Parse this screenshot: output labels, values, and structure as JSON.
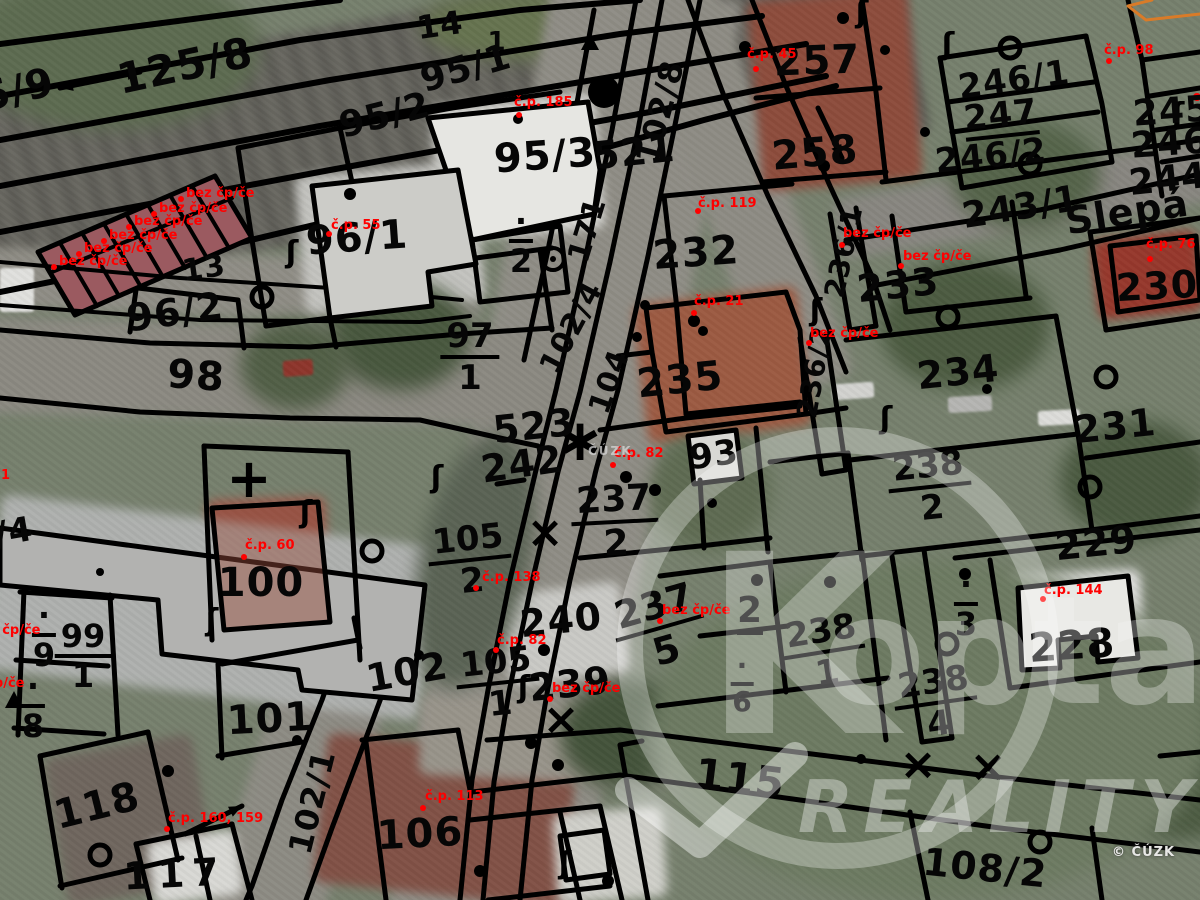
{
  "labels": {
    "parcels": [
      {
        "t": "5/9",
        "x": 18,
        "y": 90,
        "s": 40,
        "r": -14
      },
      {
        "t": "125/8",
        "x": 185,
        "y": 66,
        "s": 42,
        "r": -12
      },
      {
        "t": "14",
        "x": 440,
        "y": 25,
        "s": 32,
        "r": -8
      },
      {
        "t": "1",
        "x": 497,
        "y": 42,
        "s": 26,
        "r": 0
      },
      {
        "t": "95/1",
        "x": 466,
        "y": 69,
        "s": 36,
        "r": -16
      },
      {
        "t": "95/2",
        "x": 385,
        "y": 116,
        "s": 36,
        "r": -14
      },
      {
        "t": "95/3",
        "x": 545,
        "y": 156,
        "s": 40,
        "r": -4
      },
      {
        "t": "521",
        "x": 634,
        "y": 152,
        "s": 38,
        "r": -6
      },
      {
        "t": "102/8",
        "x": 660,
        "y": 112,
        "s": 32,
        "r": -75
      },
      {
        "t": "257",
        "x": 817,
        "y": 61,
        "s": 40,
        "r": -2
      },
      {
        "t": "258",
        "x": 815,
        "y": 153,
        "s": 40,
        "r": -5
      },
      {
        "t": "246/1",
        "x": 1014,
        "y": 80,
        "s": 34,
        "r": -8
      },
      {
        "t": "247",
        "x": 1001,
        "y": 118,
        "s": 34,
        "r": -6,
        "u": 1
      },
      {
        "t": "246/2",
        "x": 991,
        "y": 156,
        "s": 34,
        "r": -6
      },
      {
        "t": "245",
        "x": 1172,
        "y": 112,
        "s": 36,
        "r": -4
      },
      {
        "t": "246",
        "x": 1170,
        "y": 144,
        "s": 36,
        "r": -4
      },
      {
        "t": "244",
        "x": 1168,
        "y": 180,
        "s": 36,
        "r": -6
      },
      {
        "t": "243/1",
        "x": 1021,
        "y": 208,
        "s": 36,
        "r": -9
      },
      {
        "t": "Slepá",
        "x": 1127,
        "y": 212,
        "s": 38,
        "r": -9
      },
      {
        "t": "230",
        "x": 1157,
        "y": 286,
        "s": 38,
        "r": -3
      },
      {
        "t": "232",
        "x": 696,
        "y": 253,
        "s": 40,
        "r": -4
      },
      {
        "t": "233",
        "x": 898,
        "y": 285,
        "s": 38,
        "r": -6
      },
      {
        "t": "236/1",
        "x": 844,
        "y": 252,
        "s": 28,
        "r": -78
      },
      {
        "t": "236/2",
        "x": 815,
        "y": 372,
        "s": 28,
        "r": -80
      },
      {
        "t": "235",
        "x": 680,
        "y": 380,
        "s": 40,
        "r": -6
      },
      {
        "t": "93",
        "x": 714,
        "y": 455,
        "s": 34,
        "r": -8
      },
      {
        "t": "234",
        "x": 958,
        "y": 372,
        "s": 38,
        "r": -6
      },
      {
        "t": "231",
        "x": 1115,
        "y": 426,
        "s": 38,
        "r": -6
      },
      {
        "t": "229",
        "x": 1096,
        "y": 543,
        "s": 38,
        "r": -6
      },
      {
        "t": "228",
        "x": 1072,
        "y": 646,
        "s": 40,
        "r": -4
      },
      {
        "t": "242",
        "x": 522,
        "y": 464,
        "s": 38,
        "r": -8
      },
      {
        "t": "523",
        "x": 534,
        "y": 426,
        "s": 38,
        "r": -6
      },
      {
        "t": "240",
        "x": 561,
        "y": 620,
        "s": 38,
        "r": -6
      },
      {
        "t": "239",
        "x": 570,
        "y": 684,
        "s": 38,
        "r": -6
      },
      {
        "t": "2",
        "x": 750,
        "y": 614,
        "s": 36,
        "r": 0,
        "u": 1
      },
      {
        "t": "115",
        "x": 740,
        "y": 779,
        "s": 42,
        "r": 7
      },
      {
        "t": "101",
        "x": 270,
        "y": 719,
        "s": 40,
        "r": -3
      },
      {
        "t": "118",
        "x": 97,
        "y": 806,
        "s": 40,
        "r": -14
      },
      {
        "t": "117",
        "x": 175,
        "y": 874,
        "s": 38,
        "r": -3,
        "ls": 8
      },
      {
        "t": "106",
        "x": 420,
        "y": 834,
        "s": 40,
        "r": -3
      },
      {
        "t": "102",
        "x": 407,
        "y": 672,
        "s": 38,
        "r": -10
      },
      {
        "t": "102/1",
        "x": 312,
        "y": 802,
        "s": 32,
        "r": -76
      },
      {
        "t": "100",
        "x": 261,
        "y": 583,
        "s": 40,
        "r": 0
      },
      {
        "t": "98",
        "x": 196,
        "y": 376,
        "s": 40,
        "r": 4
      },
      {
        "t": "96/1",
        "x": 357,
        "y": 238,
        "s": 40,
        "r": -4
      },
      {
        "t": "96/2",
        "x": 175,
        "y": 312,
        "s": 38,
        "r": -8
      },
      {
        "t": "13",
        "x": 204,
        "y": 269,
        "s": 30,
        "r": -8
      },
      {
        "t": "108/2",
        "x": 985,
        "y": 868,
        "s": 38,
        "r": 6
      },
      {
        "t": "/4",
        "x": 14,
        "y": 532,
        "s": 34,
        "r": -10
      },
      {
        "t": "171",
        "x": 588,
        "y": 230,
        "s": 30,
        "r": -73
      },
      {
        "t": "102/4",
        "x": 572,
        "y": 328,
        "s": 30,
        "r": -62
      },
      {
        "t": "104",
        "x": 610,
        "y": 382,
        "s": 30,
        "r": -70
      }
    ],
    "fractions": [
      {
        "n": "97",
        "d": "1",
        "x": 470,
        "y": 357,
        "s": 34
      },
      {
        "n": "105",
        "d": "2",
        "x": 470,
        "y": 560,
        "s": 34,
        "r": -6
      },
      {
        "n": "105",
        "d": "1",
        "x": 498,
        "y": 683,
        "s": 34,
        "r": -6
      },
      {
        "n": "99",
        "d": "1",
        "x": 83,
        "y": 656,
        "s": 32
      },
      {
        "n": "·",
        "d": "9",
        "x": 44,
        "y": 635,
        "s": 32
      },
      {
        "n": "·",
        "d": "8",
        "x": 33,
        "y": 706,
        "s": 32
      },
      {
        "n": "·",
        "d": "2",
        "x": 521,
        "y": 241,
        "s": 32
      },
      {
        "n": "·",
        "d": "3",
        "x": 966,
        "y": 604,
        "s": 32
      },
      {
        "n": "238",
        "d": "2",
        "x": 930,
        "y": 487,
        "s": 34,
        "r": -6
      },
      {
        "n": "238",
        "d": "4",
        "x": 936,
        "y": 703,
        "s": 34,
        "r": -8
      },
      {
        "n": "238",
        "d": "1",
        "x": 824,
        "y": 652,
        "s": 34,
        "r": -9
      },
      {
        "n": "237",
        "d": "5",
        "x": 660,
        "y": 628,
        "s": 38,
        "r": -16
      },
      {
        "n": "237",
        "d": "2",
        "x": 615,
        "y": 522,
        "s": 36,
        "r": -3
      },
      {
        "n": "·",
        "d": "6",
        "x": 742,
        "y": 684,
        "s": 28
      }
    ],
    "red": [
      {
        "t": "bez čp/če",
        "x": 186,
        "y": 186,
        "dx": -8,
        "dy": 10
      },
      {
        "t": "bez čp/če",
        "x": 159,
        "y": 201,
        "dx": -8,
        "dy": 10
      },
      {
        "t": "bez čp/če",
        "x": 134,
        "y": 214,
        "dx": -8,
        "dy": 10
      },
      {
        "t": "bez čp/če",
        "x": 109,
        "y": 228,
        "dx": -8,
        "dy": 10
      },
      {
        "t": "bez čp/če",
        "x": 84,
        "y": 241,
        "dx": -8,
        "dy": 10
      },
      {
        "t": "bez čp/če",
        "x": 59,
        "y": 254,
        "dx": -8,
        "dy": 10
      },
      {
        "t": "č.p. 185",
        "x": 514,
        "y": 95,
        "dx": 2,
        "dy": 17
      },
      {
        "t": "č.p. 45",
        "x": 747,
        "y": 47,
        "dx": 6,
        "dy": 19
      },
      {
        "t": "č.p. 98",
        "x": 1104,
        "y": 43,
        "dx": 2,
        "dy": 15
      },
      {
        "t": "č.p. 55",
        "x": 331,
        "y": 218,
        "dx": -5,
        "dy": 13
      },
      {
        "t": "č.p. 119",
        "x": 698,
        "y": 196,
        "dx": -3,
        "dy": 12
      },
      {
        "t": "bez čp/če",
        "x": 843,
        "y": 226,
        "dx": -4,
        "dy": 16
      },
      {
        "t": "bez čp/če",
        "x": 903,
        "y": 249,
        "dx": -5,
        "dy": 14
      },
      {
        "t": "č.p. 76",
        "x": 1146,
        "y": 237,
        "dx": 1,
        "dy": 19
      },
      {
        "t": "bez čp/če",
        "x": 810,
        "y": 326,
        "dx": -4,
        "dy": 14
      },
      {
        "t": "č.p. 21",
        "x": 694,
        "y": 294,
        "dx": -3,
        "dy": 16
      },
      {
        "t": "č.p. 82",
        "x": 614,
        "y": 446,
        "dx": -4,
        "dy": 16
      },
      {
        "t": "bez čp/če",
        "x": 662,
        "y": 603,
        "dx": -5,
        "dy": 15
      },
      {
        "t": "č.p. 138",
        "x": 482,
        "y": 570,
        "dx": -9,
        "dy": 15
      },
      {
        "t": "č.p. 82",
        "x": 497,
        "y": 633,
        "dx": -4,
        "dy": 14
      },
      {
        "t": "bez čp/če",
        "x": 552,
        "y": 681,
        "dx": -5,
        "dy": 15
      },
      {
        "t": "č.p. 113",
        "x": 425,
        "y": 789,
        "dx": -5,
        "dy": 16
      },
      {
        "t": "č.p. 160, 159",
        "x": 168,
        "y": 811,
        "dx": -4,
        "dy": 15
      },
      {
        "t": "č.p. 60",
        "x": 245,
        "y": 538,
        "dx": -4,
        "dy": 16
      },
      {
        "t": "č.p. 144",
        "x": 1044,
        "y": 583,
        "dx": -4,
        "dy": 13
      },
      {
        "t": "bez čp/če",
        "x": -28,
        "y": 623
      },
      {
        "t": "bez čp/če",
        "x": -44,
        "y": 676
      },
      {
        "t": "1",
        "x": 1,
        "y": 468
      }
    ]
  },
  "symbols": {
    "dots": [
      [
        604,
        92,
        16
      ],
      [
        350,
        194,
        6
      ],
      [
        518,
        119,
        5
      ],
      [
        745,
        47,
        6
      ],
      [
        824,
        166,
        6
      ],
      [
        843,
        18,
        6
      ],
      [
        885,
        50,
        5
      ],
      [
        694,
        321,
        6
      ],
      [
        703,
        331,
        5
      ],
      [
        626,
        477,
        6
      ],
      [
        655,
        490,
        6
      ],
      [
        712,
        503,
        5
      ],
      [
        757,
        580,
        6
      ],
      [
        830,
        582,
        6
      ],
      [
        965,
        574,
        6
      ],
      [
        987,
        389,
        5
      ],
      [
        168,
        771,
        6
      ],
      [
        531,
        743,
        6
      ],
      [
        558,
        765,
        6
      ],
      [
        480,
        871,
        6
      ],
      [
        608,
        881,
        6
      ],
      [
        645,
        305,
        5
      ],
      [
        637,
        337,
        5
      ],
      [
        861,
        759,
        5
      ],
      [
        544,
        650,
        6
      ],
      [
        419,
        655,
        5
      ],
      [
        100,
        572,
        4
      ],
      [
        297,
        740,
        5
      ],
      [
        925,
        132,
        5
      ]
    ],
    "red_dots": [
      [
        1197,
        97
      ]
    ],
    "circles": [
      [
        262,
        297
      ],
      [
        372,
        551
      ],
      [
        948,
        317
      ],
      [
        1106,
        377
      ],
      [
        1090,
        487
      ],
      [
        947,
        644
      ],
      [
        1040,
        842
      ],
      [
        1010,
        48
      ],
      [
        1030,
        164
      ],
      [
        100,
        855
      ]
    ],
    "circle_dots": [
      [
        553,
        259
      ]
    ],
    "hooks": [
      [
        292,
        262
      ],
      [
        437,
        487
      ],
      [
        862,
        22
      ],
      [
        948,
        54
      ],
      [
        816,
        320
      ],
      [
        212,
        630
      ],
      [
        565,
        873
      ],
      [
        1178,
        124
      ],
      [
        524,
        697
      ],
      [
        306,
        522
      ],
      [
        886,
        428
      ]
    ],
    "plus_marks": [
      [
        249,
        497
      ]
    ],
    "x_marks": [
      [
        561,
        734
      ],
      [
        918,
        779
      ],
      [
        988,
        781
      ],
      [
        545,
        547
      ]
    ],
    "asterisks": [
      [
        580,
        460
      ]
    ],
    "triangles": [
      [
        590,
        42
      ],
      [
        14,
        700
      ]
    ],
    "arrows": [
      {
        "x1": 60,
        "y1": 88,
        "x2": 140,
        "y2": 72,
        "double": true
      },
      {
        "x1": 185,
        "y1": 834,
        "x2": 242,
        "y2": 806
      },
      {
        "x1": 818,
        "y1": 108,
        "x2": 842,
        "y2": 158
      }
    ]
  },
  "watermark": {
    "logo_letter": "K",
    "brand": "opta",
    "tagline": "REALITY",
    "cuzk": "ČÚZK",
    "copyright": "© ČÚZK"
  },
  "colors": {
    "line": "#000000",
    "red_label": "#ff0000",
    "strip_fill": "#9b5a60",
    "orange_line": "#d97b28"
  }
}
